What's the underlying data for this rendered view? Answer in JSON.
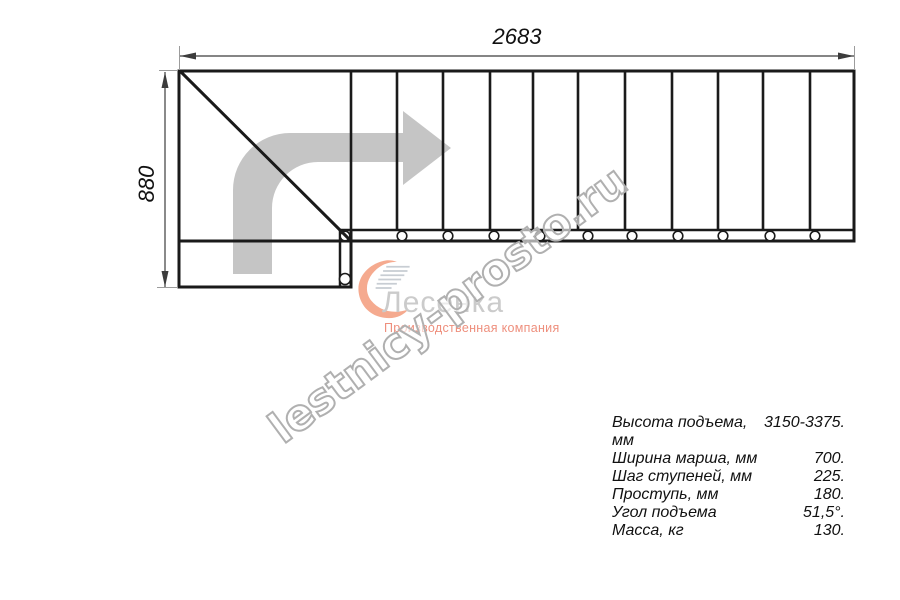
{
  "page": {
    "background": "#ffffff"
  },
  "dimensions": {
    "width_label": "2683",
    "height_label": "880"
  },
  "drawing": {
    "line_color": "#1a1a1a",
    "thin_line_color": "#3c3c3c",
    "extension_line_color": "#9c9c9c",
    "arrow_color": "#c5c5c5",
    "circle_fill": "#ffffff",
    "main_rect": {
      "x": 179,
      "y": 71,
      "w": 675,
      "h": 170
    },
    "landing_rect": {
      "x": 179,
      "y": 241,
      "w": 172,
      "h": 46
    },
    "inner_rail_line": {
      "x1": 340,
      "y1": 230,
      "x2": 853,
      "y2": 230
    },
    "corner_post_line": {
      "x1": 340,
      "y1": 230,
      "x2": 340,
      "y2": 286
    },
    "first_step_extension": {
      "x1": 351,
      "y1": 230,
      "x2": 351,
      "y2": 241
    },
    "diagonal": {
      "x1": 181,
      "y1": 72,
      "x2": 350,
      "y2": 240
    },
    "step_lines": [
      351,
      397,
      443,
      490,
      533,
      578,
      625,
      672,
      718,
      763,
      810
    ],
    "step_y1": 71,
    "step_y2": 230,
    "balusters": {
      "cy": 236,
      "r": 4.8,
      "cx": [
        345,
        402,
        448,
        494,
        540,
        588,
        632,
        678,
        723,
        770,
        815
      ]
    },
    "landing_baluster": {
      "cx": 345,
      "cy": 279,
      "r": 5.5
    },
    "direction_arrow_path": "M233,274 L233,190 A57,57 0 0 1 290,133 L403,133 L403,111 L451,148 L403,185 L403,162 L318,162 A46,46 0 0 0 272,208 L272,274 Z",
    "dim_top": {
      "y": 56,
      "x1": 180,
      "x2": 854,
      "arrowheads": [
        "180,56 196,52.5 196,59.5",
        "854,56 838,52.5 838,59.5"
      ],
      "ext": [
        [
          179.5,
          46,
          179.5,
          70
        ],
        [
          854.5,
          46,
          854.5,
          70
        ]
      ]
    },
    "dim_left": {
      "x": 165,
      "y1": 72,
      "y2": 287,
      "arrowheads": [
        "165,72 161.5,88 168.5,88",
        "165,287 161.5,271 168.5,271"
      ],
      "ext": [
        [
          159,
          70.5,
          178,
          70.5
        ],
        [
          157,
          287.5,
          178,
          287.5
        ]
      ]
    }
  },
  "logo": {
    "name": "Лесенка",
    "tagline": "Производственная компания",
    "name_color": "#cbcbcb",
    "tagline_color": "#ee8f7d",
    "mark_color": "#f5aa8f",
    "mark_lines_color": "#c8cdd3"
  },
  "watermark": {
    "text": "lestnicy-prosto.ru",
    "stroke_color": "#b0b0b0",
    "fill_color": "rgba(255,255,255,0.62)"
  },
  "specs": {
    "rows": [
      {
        "label": "Высота подъема, мм",
        "value": "3150-3375."
      },
      {
        "label": "Ширина марша, мм",
        "value": "700."
      },
      {
        "label": "Шаг ступеней, мм",
        "value": "225."
      },
      {
        "label": "Проступь, мм",
        "value": "180."
      },
      {
        "label": "Угол подъема",
        "value": "51,5°."
      },
      {
        "label": "Масса, кг",
        "value": "130."
      }
    ]
  }
}
